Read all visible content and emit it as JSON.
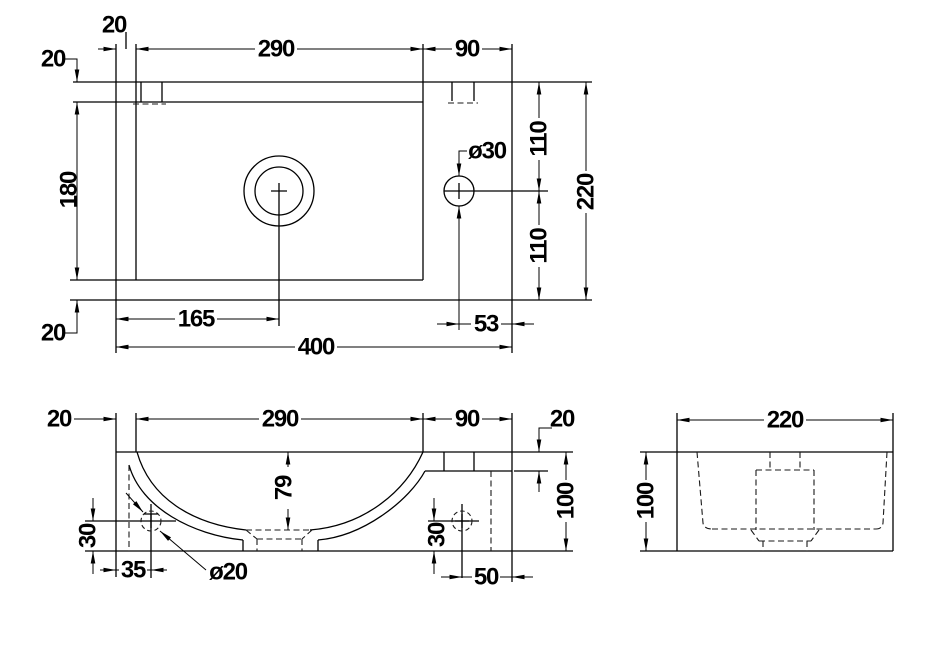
{
  "meta": {
    "background_color": "#ffffff",
    "line_color": "#000000",
    "drawing_type": "three-view dimensioned technical drawing"
  },
  "plan": {
    "d20_left_rim": "20",
    "d290_bowl_width": "290",
    "d90_deck_width": "90",
    "d20_top_rim": "20",
    "d180_bowl_depth": "180",
    "d20_bottom_rim": "20",
    "d165_drain_offset": "165",
    "d53_tap_offset": "53",
    "d400_overall_width": "400",
    "d110_upper": "110",
    "d110_lower": "110",
    "d220_overall_depth": "220",
    "dia30_tap_hole": "ø30"
  },
  "front": {
    "d20_left_rim": "20",
    "d290_bowl_width": "290",
    "d90_deck_width": "90",
    "d20_deck_thickness": "20",
    "d79_bowl_depth": "79",
    "d35_hole_offset_x": "35",
    "d30_hole_left_y": "30",
    "dia20_hole": "ø20",
    "d30_hole_right_y": "30",
    "d50_hole_offset_x": "50",
    "d100_height": "100"
  },
  "side": {
    "d220_width": "220",
    "d100_height": "100"
  }
}
